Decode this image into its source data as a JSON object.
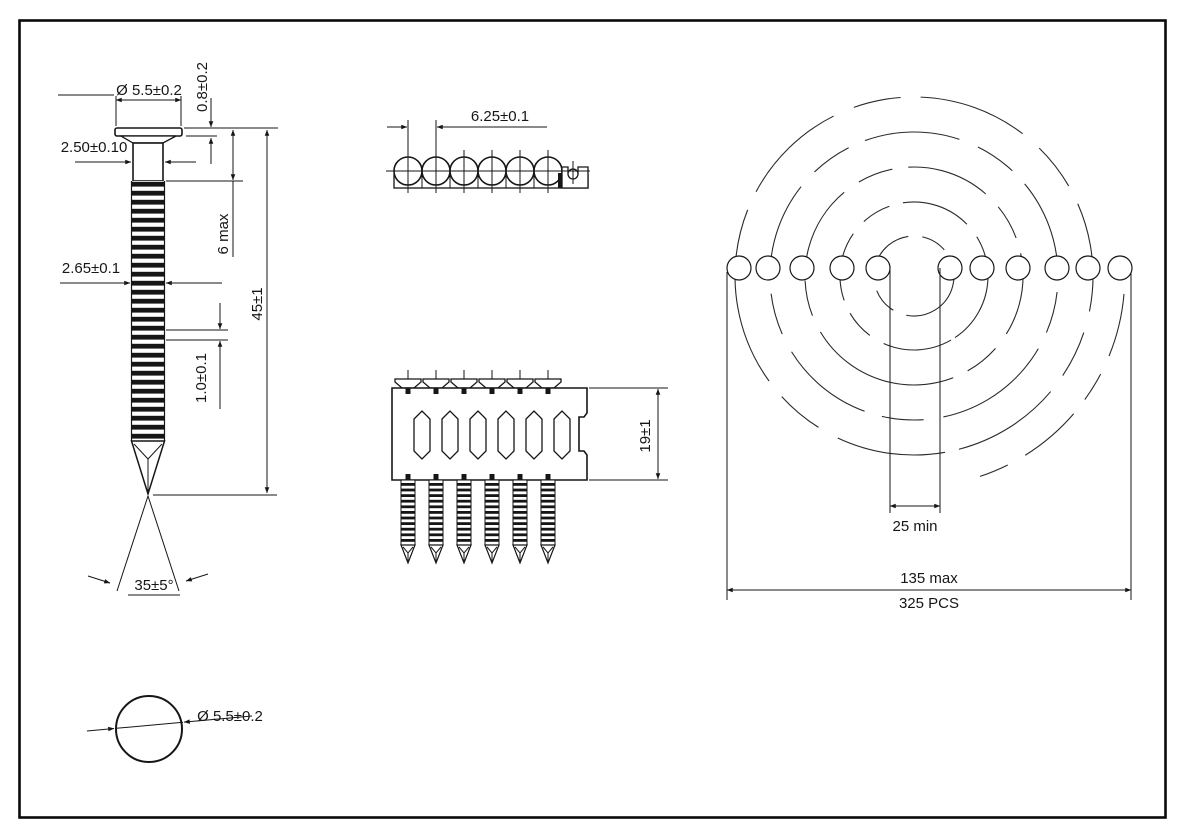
{
  "drawing": {
    "title_semantic": "Ring shank coil nail technical drawing",
    "line_color": "#161616",
    "nail_front_view": {
      "head_diameter": "Ø 5.5±0.2",
      "head_thickness": "0.8±0.2",
      "shank_diameter_under_head": "2.50±0.10",
      "smooth_shank_length": "6 max",
      "overall_length": "45±1",
      "ring_shank_diameter": "2.65±0.1",
      "ring_pitch": "1.0±0.1",
      "point_angle": "35±5°"
    },
    "strip_top_view": {
      "nail_spacing": "6.25±0.1"
    },
    "strip_side_view": {
      "collation_height": "19±1"
    },
    "coil_view": {
      "inner_diameter": "25 min",
      "outer_diameter": "135 max",
      "piece_count": "325 PCS"
    },
    "head_top_view": {
      "head_diameter": "Ø 5.5±0.2"
    }
  }
}
